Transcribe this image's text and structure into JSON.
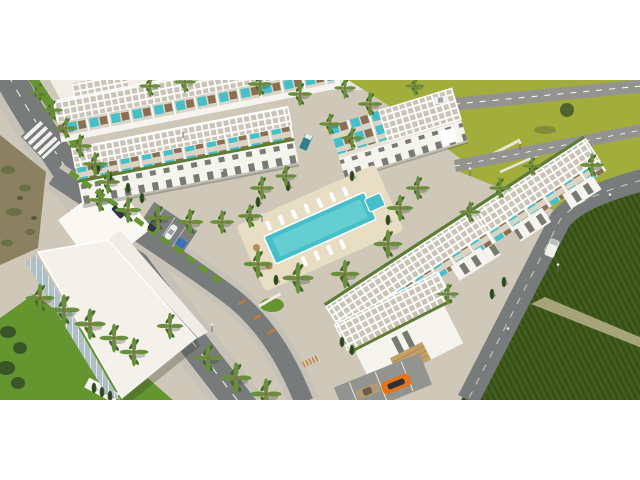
{
  "image": {
    "alt": "Aerial 3D render of a white modern resort residential complex: rows of townhouses with white rooftop pergolas and plunge-pool terraces, a central turquoise swimming pool with sun loungers, a white clubhouse, palm-lined streets, bright lawns and dark-green farmland on the right"
  },
  "frame": {
    "background": "#ffffff",
    "photo_top": 80,
    "photo_height": 320
  },
  "palette": {
    "pavement": "#cfc8b8",
    "plaza": "#ddd5c2",
    "road": "#787b7c",
    "road_light": "#93948f",
    "sidewalk": "#c6c2b7",
    "lawn": "#a2ae3c",
    "grass": "#64952f",
    "field": "#425d1d",
    "field_dark": "#374f17",
    "gravel": "#c9bd9a",
    "dirt": "#8b8161",
    "scrub": "#6b6f45",
    "building_white": "#f6f4ee",
    "building_shadow": "#e6e1d4",
    "pergola_base": "#cac4b6",
    "pergola_line": "#ffffff",
    "glass": "#aebfc6",
    "window": "#5b5b55",
    "roof_green": "#5d7c35",
    "pool": "#45bfc8",
    "pool_light": "#8adfe0",
    "deck": "#e7ddc3",
    "palm_light": "#6a8f3c",
    "palm_dark": "#49682c",
    "cypress": "#3a5628",
    "stone": "#c69f66",
    "bench_orange": "#c97a33",
    "car_orange": "#e4731c",
    "car_white": "#eef0ef",
    "car_dark": "#30363a",
    "car_teal": "#2f7e8a",
    "car_beige": "#b09a7a",
    "handicap_blue": "#2f6fbe",
    "distant_strip": "#e9e6df",
    "shadow": "rgba(50,55,40,0.28)"
  },
  "scene": {
    "pool": {
      "color": "#45bfc8"
    },
    "vehicles": [
      {
        "name": "white-car-highway",
        "color": "#eef0ef"
      },
      {
        "name": "white-van",
        "color": "#f0efe9"
      },
      {
        "name": "teal-truck",
        "color": "#2f7e8a"
      },
      {
        "name": "dark-suv",
        "color": "#30363a"
      },
      {
        "name": "white-hatchback",
        "color": "#eef0ef"
      },
      {
        "name": "dark-sedan",
        "color": "#2e3440"
      },
      {
        "name": "beige-car",
        "color": "#b09a7a"
      },
      {
        "name": "orange-sports-car",
        "color": "#e4731c"
      }
    ]
  }
}
